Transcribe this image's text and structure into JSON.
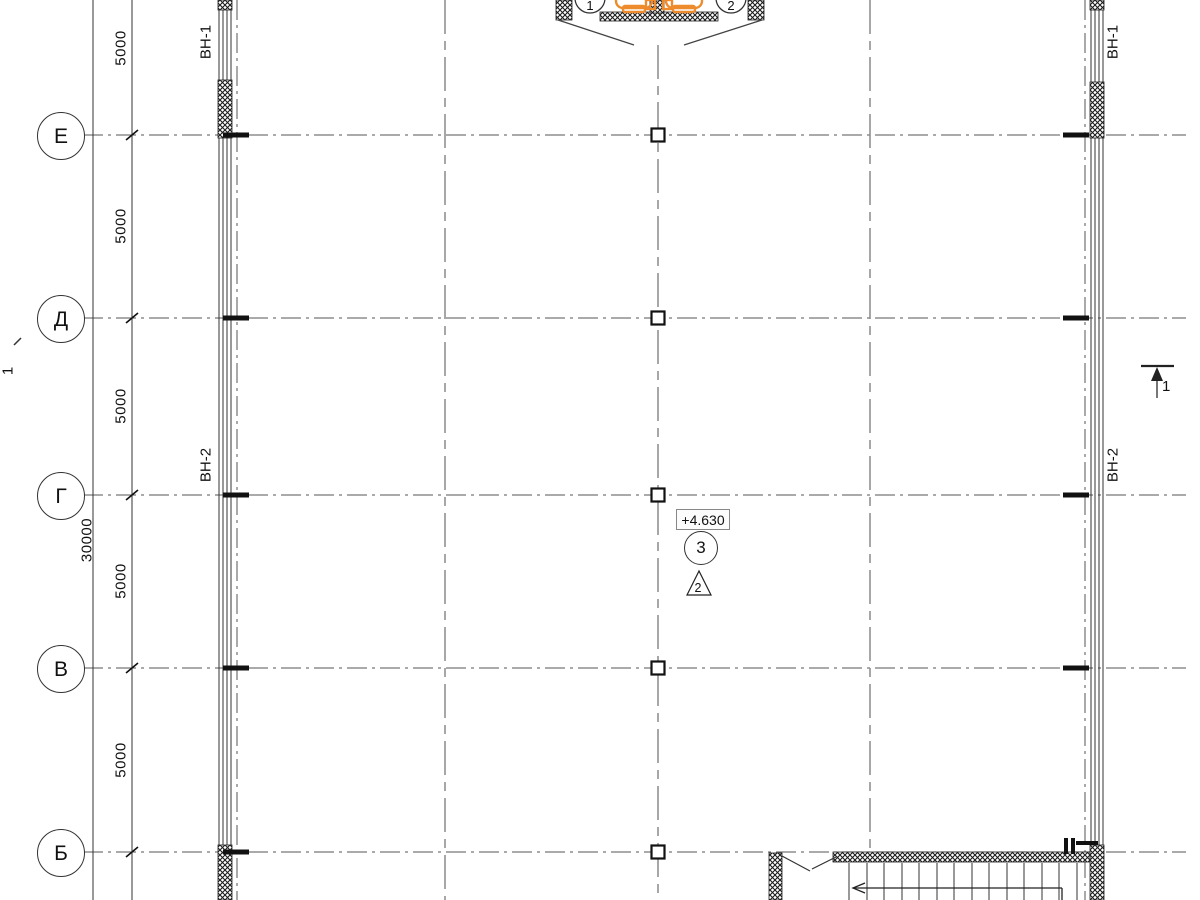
{
  "drawing": {
    "row_grid_labels": [
      "Е",
      "Д",
      "Г",
      "В",
      "Б"
    ],
    "top_grid_labels": [
      "1",
      "2"
    ],
    "dimensions": {
      "segments": [
        "5000",
        "5000",
        "5000",
        "5000",
        "5000"
      ],
      "total": "30000"
    },
    "windows": {
      "left": [
        "ВН-1",
        "ВН-2"
      ],
      "right": [
        "ВН-1",
        "ВН-2"
      ]
    },
    "annotations": {
      "elevation": "+4.630",
      "node_circle": "3",
      "triangle_mark": "2",
      "section_mark_left": "1",
      "section_mark_right": "1"
    },
    "colors": {
      "accent_orange": "#ED8B2D",
      "line_dark": "#1c1c1c",
      "line_gray": "#8a8a8a"
    }
  }
}
